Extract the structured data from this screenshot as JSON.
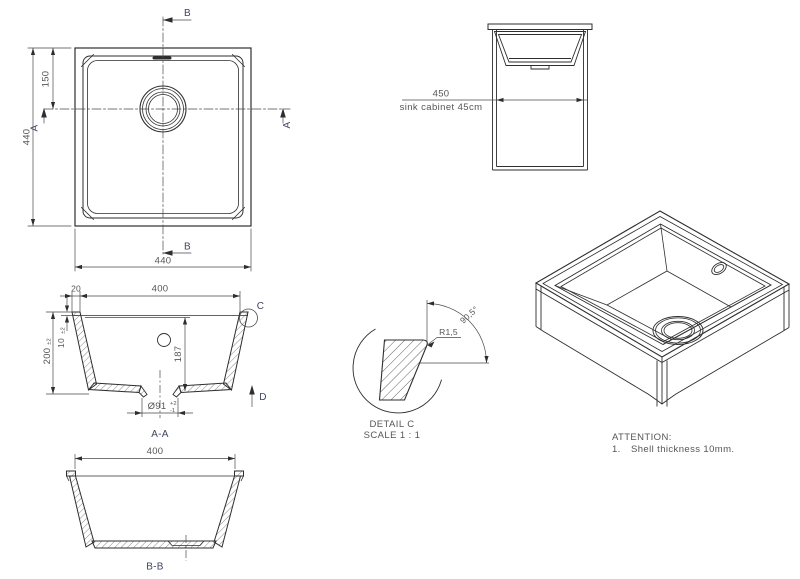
{
  "title": "sink technical drawing",
  "colors": {
    "background": "#ffffff",
    "line": "#2e2e2e",
    "dim_line": "#4a4a4a",
    "dim_text": "#555555",
    "marker_text": "#3d4661"
  },
  "views": {
    "top": {
      "width": "440",
      "height": "440",
      "drain_offset": "150",
      "marker_a": "A",
      "marker_b": "B"
    },
    "cabinet": {
      "width": "450",
      "caption": "sink cabinet 45cm"
    },
    "aa": {
      "rim": "20",
      "opening": "400",
      "depth": "200",
      "depth_tol": "±2",
      "shell": "10",
      "shell_tol": "±2",
      "inner_depth": "187",
      "drain": "Ø91",
      "drain_tol_plus": "+2",
      "drain_tol_minus": "-1",
      "detail_marker": "C",
      "direction_marker": "D",
      "label": "A-A"
    },
    "detail_c": {
      "radius": "R1,5",
      "angle": "90,5°",
      "title": "DETAIL C",
      "scale": "SCALE 1 : 1"
    },
    "bb": {
      "opening": "400",
      "label": "B-B"
    },
    "notes": {
      "title": "ATTENTION:",
      "item_no": "1.",
      "item_text": "Shell thickness 10mm."
    }
  }
}
